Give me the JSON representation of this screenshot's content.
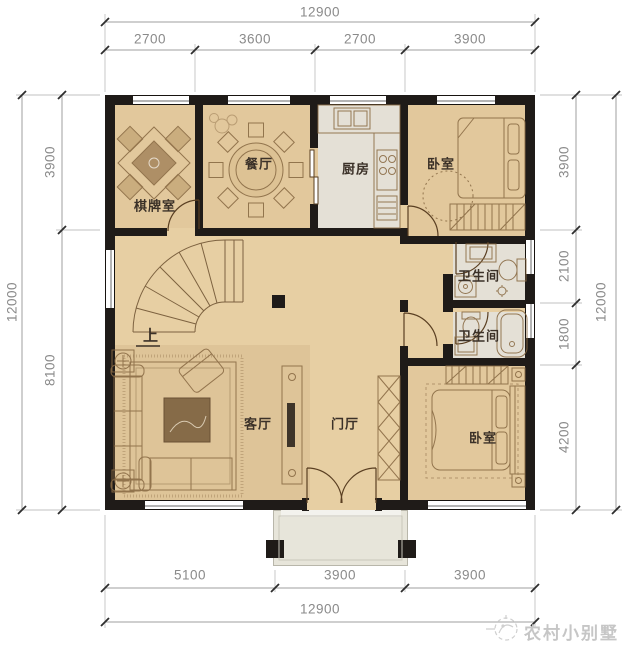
{
  "dimensions": {
    "top": {
      "total": "12900",
      "segments": [
        "2700",
        "3600",
        "2700",
        "3900"
      ]
    },
    "bottom": {
      "total": "12900",
      "segments": [
        "5100",
        "3900",
        "3900"
      ]
    },
    "left": {
      "total": "12000",
      "segments": [
        "3900",
        "8100"
      ]
    },
    "right": {
      "total": "12000",
      "segments": [
        "3900",
        "2100",
        "1800",
        "4200"
      ]
    }
  },
  "rooms": {
    "chess_room": "棋牌室",
    "dining_room": "餐厅",
    "kitchen": "厨房",
    "bedroom_top": "卧室",
    "bathroom_upper": "卫生间",
    "bathroom_lower": "卫生间",
    "living_room": "客厅",
    "foyer": "门厅",
    "bedroom_bottom": "卧室",
    "stair_direction": "上"
  },
  "watermark": {
    "brand": "农村小别墅",
    "logo_icon": "rooster-logo-icon"
  },
  "colors": {
    "wall": "#1f1b18",
    "floor_wood": "#e7cfa3",
    "floor_tile": "#e4e0d6",
    "porch": "#e7e5da",
    "furniture_line": "#8a6b45",
    "dimension_text": "#8a8a8a",
    "room_label": "#3b3128",
    "watermark": "#c6c6c6"
  }
}
